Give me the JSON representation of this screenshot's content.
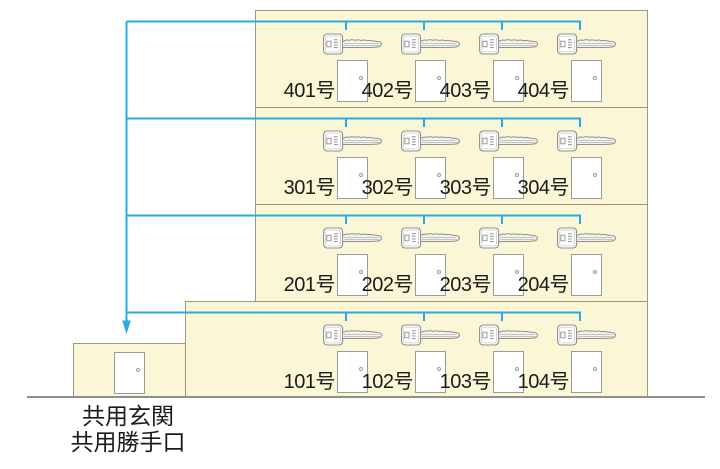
{
  "diagram": "apartment-master-key-distribution",
  "colors": {
    "accent_blue": "#29ABE2",
    "floor_fill": "#FBF7D6",
    "floor_border": "#9C9884",
    "ground_line": "#8F8F8F",
    "door_border": "#9B9B9B",
    "text": "#1A1A1A"
  },
  "building": {
    "floors": [
      {
        "level": 4,
        "rooms": [
          {
            "label": "401号"
          },
          {
            "label": "402号"
          },
          {
            "label": "403号"
          },
          {
            "label": "404号"
          }
        ]
      },
      {
        "level": 3,
        "rooms": [
          {
            "label": "301号"
          },
          {
            "label": "302号"
          },
          {
            "label": "303号"
          },
          {
            "label": "304号"
          }
        ]
      },
      {
        "level": 2,
        "rooms": [
          {
            "label": "201号"
          },
          {
            "label": "202号"
          },
          {
            "label": "203号"
          },
          {
            "label": "204号"
          }
        ]
      },
      {
        "level": 1,
        "rooms": [
          {
            "label": "101号"
          },
          {
            "label": "102号"
          },
          {
            "label": "103号"
          },
          {
            "label": "104号"
          }
        ]
      }
    ]
  },
  "entrance": {
    "line1": "共用玄関",
    "line2": "共用勝手口"
  },
  "icons": {
    "key": "key-icon",
    "door": "door-icon",
    "arrow": "arrow-down-icon"
  }
}
